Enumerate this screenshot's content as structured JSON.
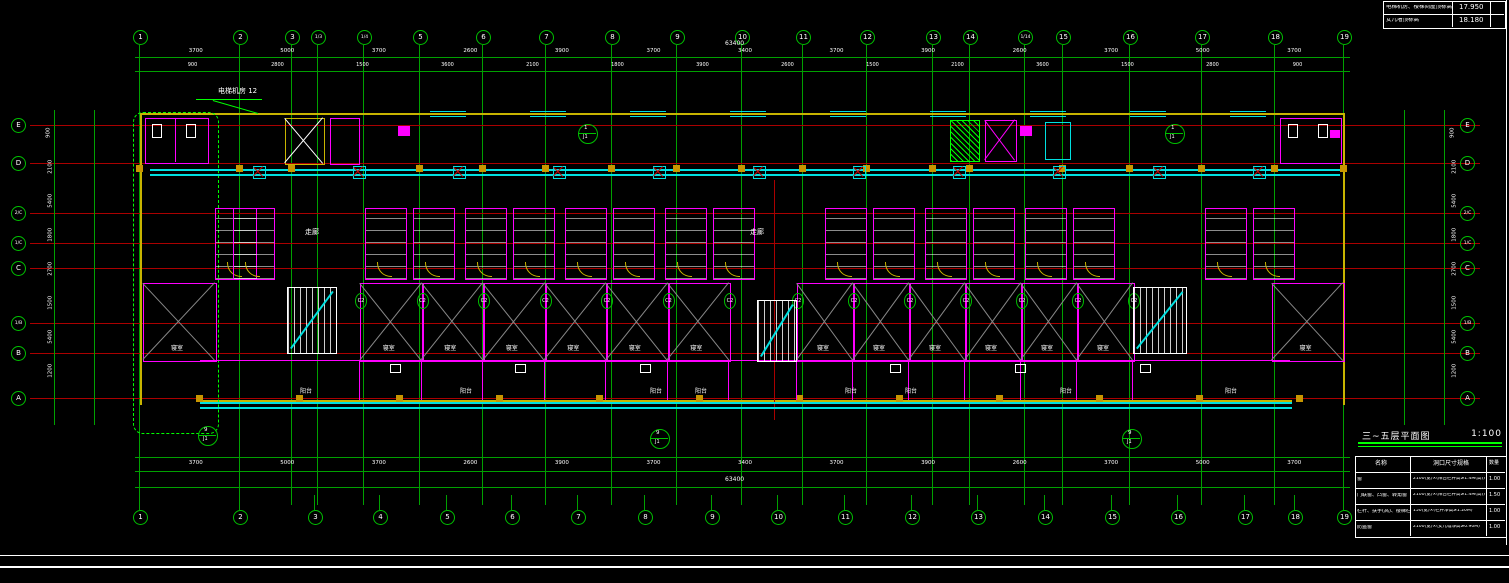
{
  "title_block": {
    "title": "三~五层平面图",
    "scale": "1:100"
  },
  "elevation_box": {
    "rows": [
      {
        "label": "电梯机房、楼梯间屋顶标高",
        "value": "17.950"
      },
      {
        "label": "女儿墙顶标高",
        "value": "18.180"
      }
    ]
  },
  "schedule_table": {
    "headers": [
      "名称",
      "洞口尺寸规格",
      "数量"
    ],
    "rows": [
      [
        "窗",
        "2100(宽)×(阳台栏杆高≥1.4M(高))",
        "1.00"
      ],
      [
        "门联窗、凸窗、转角窗",
        "2100(宽)×(阳台栏杆高≥1.4M(高))",
        "1.50"
      ],
      [
        "栏杆、扶手(高)、楼梯栏杆",
        "150(宽)×(栏杆净高≥1.20M)",
        "1.00"
      ],
      [
        "防盗窗",
        "2100(宽)×(女儿墙净高≥0.90M)",
        "1.00"
      ]
    ]
  },
  "grid": {
    "top_bubbles": [
      [
        "1",
        140
      ],
      [
        "2",
        240
      ],
      [
        "3",
        292
      ],
      [
        "1/3",
        318
      ],
      [
        "1/4",
        364
      ],
      [
        "5",
        420
      ],
      [
        "6",
        483
      ],
      [
        "7",
        546
      ],
      [
        "8",
        612
      ],
      [
        "9",
        677
      ],
      [
        "10",
        742
      ],
      [
        "11",
        803
      ],
      [
        "12",
        867
      ],
      [
        "13",
        933
      ],
      [
        "14",
        970
      ],
      [
        "1/14",
        1025
      ],
      [
        "15",
        1063
      ],
      [
        "16",
        1130
      ],
      [
        "17",
        1202
      ],
      [
        "18",
        1275
      ],
      [
        "19",
        1344
      ]
    ],
    "bottom_bubbles": [
      [
        "1",
        140
      ],
      [
        "2",
        240
      ],
      [
        "3",
        315
      ],
      [
        "4",
        380
      ],
      [
        "5",
        447
      ],
      [
        "6",
        512
      ],
      [
        "7",
        578
      ],
      [
        "8",
        645
      ],
      [
        "9",
        712
      ],
      [
        "10",
        778
      ],
      [
        "11",
        845
      ],
      [
        "12",
        912
      ],
      [
        "13",
        978
      ],
      [
        "14",
        1045
      ],
      [
        "15",
        1112
      ],
      [
        "16",
        1178
      ],
      [
        "17",
        1245
      ],
      [
        "18",
        1295
      ],
      [
        "19",
        1344
      ]
    ],
    "left_bubbles": [
      [
        "E",
        125
      ],
      [
        "D",
        163
      ],
      [
        "2/C",
        213
      ],
      [
        "1/C",
        243
      ],
      [
        "C",
        268
      ],
      [
        "1/B",
        323
      ],
      [
        "B",
        353
      ],
      [
        "A",
        398
      ]
    ],
    "right_bubbles": [
      [
        "E",
        125
      ],
      [
        "D",
        163
      ],
      [
        "2/C",
        213
      ],
      [
        "1/C",
        243
      ],
      [
        "C",
        268
      ],
      [
        "1/B",
        323
      ],
      [
        "B",
        353
      ],
      [
        "A",
        398
      ]
    ]
  },
  "dimensions": {
    "top_total": "63400",
    "top_row1": [
      "3700",
      "5000",
      "3700",
      "2600",
      "3900",
      "3700",
      "3400",
      "3700",
      "3900",
      "2600",
      "3700",
      "5000",
      "3700"
    ],
    "top_row2": [
      "900",
      "2800",
      "1500",
      "3600",
      "2100",
      "1800",
      "3900",
      "2600",
      "1500",
      "2100",
      "3600",
      "1500",
      "2800",
      "900"
    ],
    "bottom_total": "63400",
    "bottom_row": [
      "3700",
      "5000",
      "3700",
      "2600",
      "3900",
      "3700",
      "3400",
      "3700",
      "3900",
      "2600",
      "3700",
      "5000",
      "3700"
    ],
    "left_col": [
      "900",
      "2100",
      "5400",
      "1800",
      "2700",
      "1500",
      "5400",
      "1200"
    ],
    "right_col": [
      "900",
      "2100",
      "5400",
      "1800",
      "2700",
      "1500",
      "5400",
      "1200"
    ]
  },
  "annotations": {
    "elevator_note": "电梯机房 12",
    "corridor": "走廊",
    "room": "寝室",
    "balcony": "阳台",
    "window_tag": "C2",
    "detail_top": "9",
    "detail_bottom": "J1",
    "section_top": "1",
    "section_bottom": "J1"
  },
  "colors": {
    "grid_green": "#00a000",
    "bright_green": "#00ff00",
    "bubble_green": "#00c000",
    "axis_red": "#aa0000",
    "cyan": "#00e0e0",
    "magenta": "#ff00ff",
    "wall_yellow": "#c8b400",
    "column_fill": "#c89600",
    "white": "#ffffff",
    "grey": "#888888"
  }
}
